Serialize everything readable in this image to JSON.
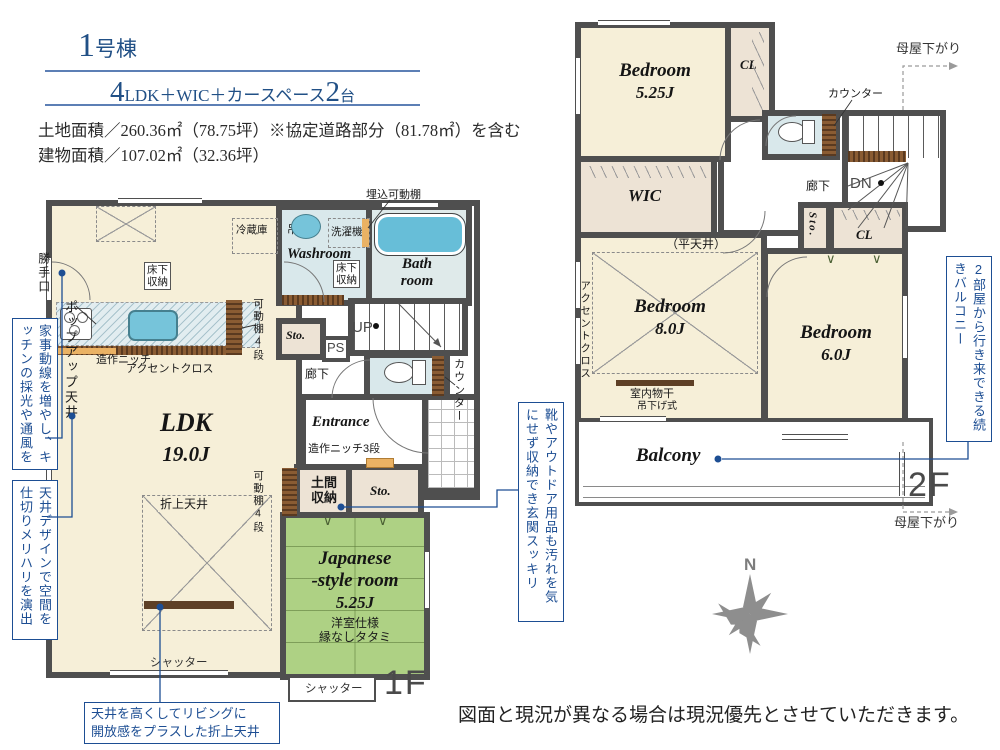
{
  "header": {
    "unit_num": "1",
    "unit_suffix": "号棟",
    "plan_n1": "4",
    "plan_mid": "LDK＋WIC＋カースペース",
    "plan_n2": "2",
    "plan_tail": "台",
    "land_area": "土地面積／260.36㎡（78.75坪）※協定道路部分（81.78㎡）を含む",
    "building_area": "建物面積／107.02㎡（32.36坪）"
  },
  "f1": {
    "floor_tag": "1F",
    "ldk_name": "LDK",
    "ldk_size": "19.0J",
    "jp_l1": "Japanese",
    "jp_l2": "-style room",
    "jp_size": "5.25J",
    "jp_note1": "洋室仕様",
    "jp_note2": "縁なしタタミ",
    "washroom": "Washroom",
    "bath_l1": "Bath",
    "bath_l2": "room",
    "entrance": "Entrance",
    "sto": "Sto.",
    "doma_l1": "土間",
    "doma_l2": "収納",
    "yukashita_l1": "床下",
    "yukashita_l2": "収納",
    "reizoko": "冷蔵庫",
    "tsurido": "吊戸有",
    "sentakuki": "洗濯機",
    "umekomi": "埋込可動棚",
    "kadoudana": "可動棚4段",
    "zosaku_niche": "造作ニッチ",
    "accent": "アクセントクロス",
    "niche3": "造作ニッチ3段",
    "up": "UP",
    "ps": "PS",
    "rouka": "廊下",
    "counter": "カウンター",
    "oriage": "折上天井",
    "shutter": "シャッター",
    "katteguchi": "勝手口",
    "popup": "ポップアップ天井"
  },
  "f2": {
    "floor_tag": "2F",
    "br1_name": "Bedroom",
    "br1_size": "5.25J",
    "br2_name": "Bedroom",
    "br2_size": "8.0J",
    "br3_name": "Bedroom",
    "br3_size": "6.0J",
    "wic": "WIC",
    "hiratenjo": "（平天井）",
    "cl": "CL",
    "sto": "Sto.",
    "rouka": "廊下",
    "dn": "DN",
    "counter": "カウンター",
    "accent": "アクセントクロス",
    "monohoshi": "室内物干",
    "tsurisage": "吊下げ式",
    "balcony": "Balcony",
    "moya": "母屋下がり"
  },
  "ann": {
    "kaji": "家事動線を増やし、キッチンの採光や通風を",
    "ceiling_design": "天井デザインで空間を仕切りメリハリを演出",
    "oriage_l1": "天井を高くしてリビングに",
    "oriage_l2": "開放感をプラスした折上天井",
    "genkan": "靴やアウトドア用品も汚れを気にせず収納でき玄関スッキリ",
    "balcony": "2部屋から行き来できる続きバルコニー"
  },
  "misc": {
    "compass_n": "N",
    "disclaimer": "図面と現況が異なる場合は現況優先とさせていただきます。"
  },
  "colors": {
    "navy": "#1d4e93",
    "wall": "#4f4f4f",
    "cream": "#f6efd8",
    "tatami_green": "#aed184",
    "wet_blue": "#d9e8eb",
    "tub_blue": "#67bed8",
    "closet_beige": "#ede3d5",
    "wood_brown": "#7b4f28",
    "niche_orange": "#eab264"
  }
}
